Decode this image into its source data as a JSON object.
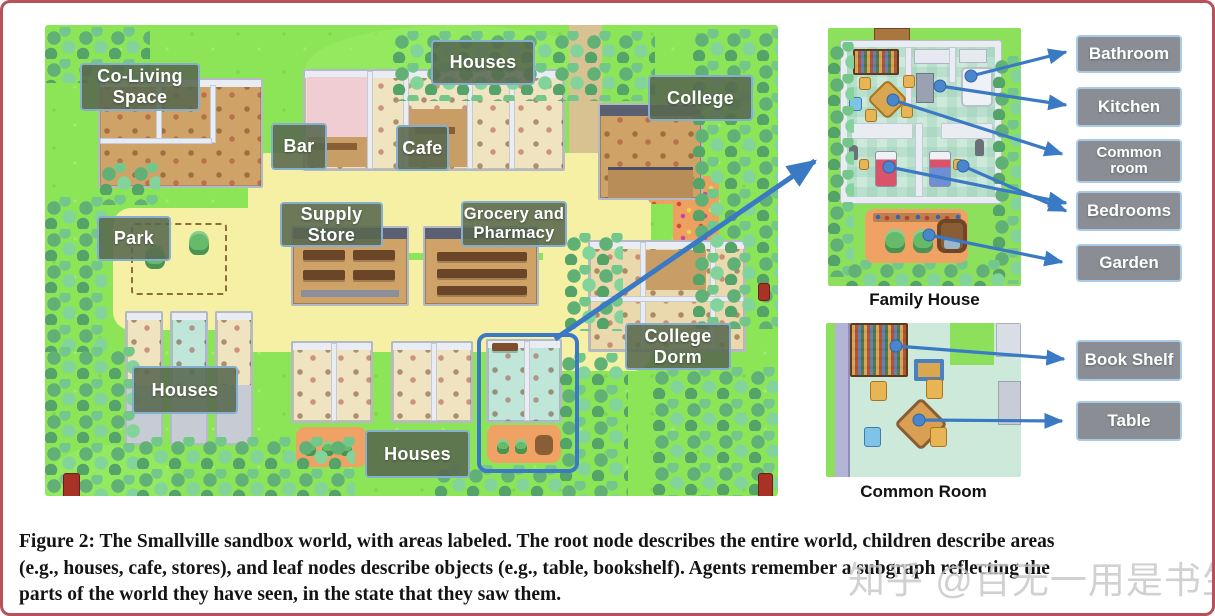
{
  "figure": {
    "caption_lines": [
      "Figure 2: The Smallville sandbox world, with areas labeled. The root node describes the entire world, children describe areas",
      "(e.g., houses, cafe, stores), and leaf nodes describe objects (e.g., table, bookshelf). Agents remember a subgraph reflecting the",
      "parts of the world they have seen, in the state that they saw them."
    ],
    "watermark": "知乎 @百无一用是书生"
  },
  "map": {
    "labels": [
      {
        "id": "co-living-space",
        "text": "Co-Living Space"
      },
      {
        "id": "houses-north",
        "text": "Houses"
      },
      {
        "id": "college",
        "text": "College"
      },
      {
        "id": "bar",
        "text": "Bar"
      },
      {
        "id": "cafe",
        "text": "Cafe"
      },
      {
        "id": "supply-store",
        "text": "Supply Store"
      },
      {
        "id": "grocery-pharmacy",
        "text": "Grocery and Pharmacy"
      },
      {
        "id": "park",
        "text": "Park"
      },
      {
        "id": "college-dorm",
        "text": "College Dorm"
      },
      {
        "id": "houses-west",
        "text": "Houses"
      },
      {
        "id": "houses-south",
        "text": "Houses"
      }
    ]
  },
  "family_house": {
    "caption": "Family House",
    "labels": [
      "Bathroom",
      "Kitchen",
      "Common room",
      "Bedrooms",
      "Garden"
    ]
  },
  "common_room": {
    "caption": "Common Room",
    "labels": [
      "Book Shelf",
      "Table"
    ]
  },
  "colors": {
    "frame_border": "#b5525c",
    "map_label_bg": "#58684e",
    "map_label_border": "#85aecf",
    "side_label_bg": "#8a8e94",
    "side_label_border": "#a9cbe8",
    "arrow_blue": "#3a79c4",
    "grass_green": "#8ce556",
    "path_yellow": "#f5f0a4"
  }
}
